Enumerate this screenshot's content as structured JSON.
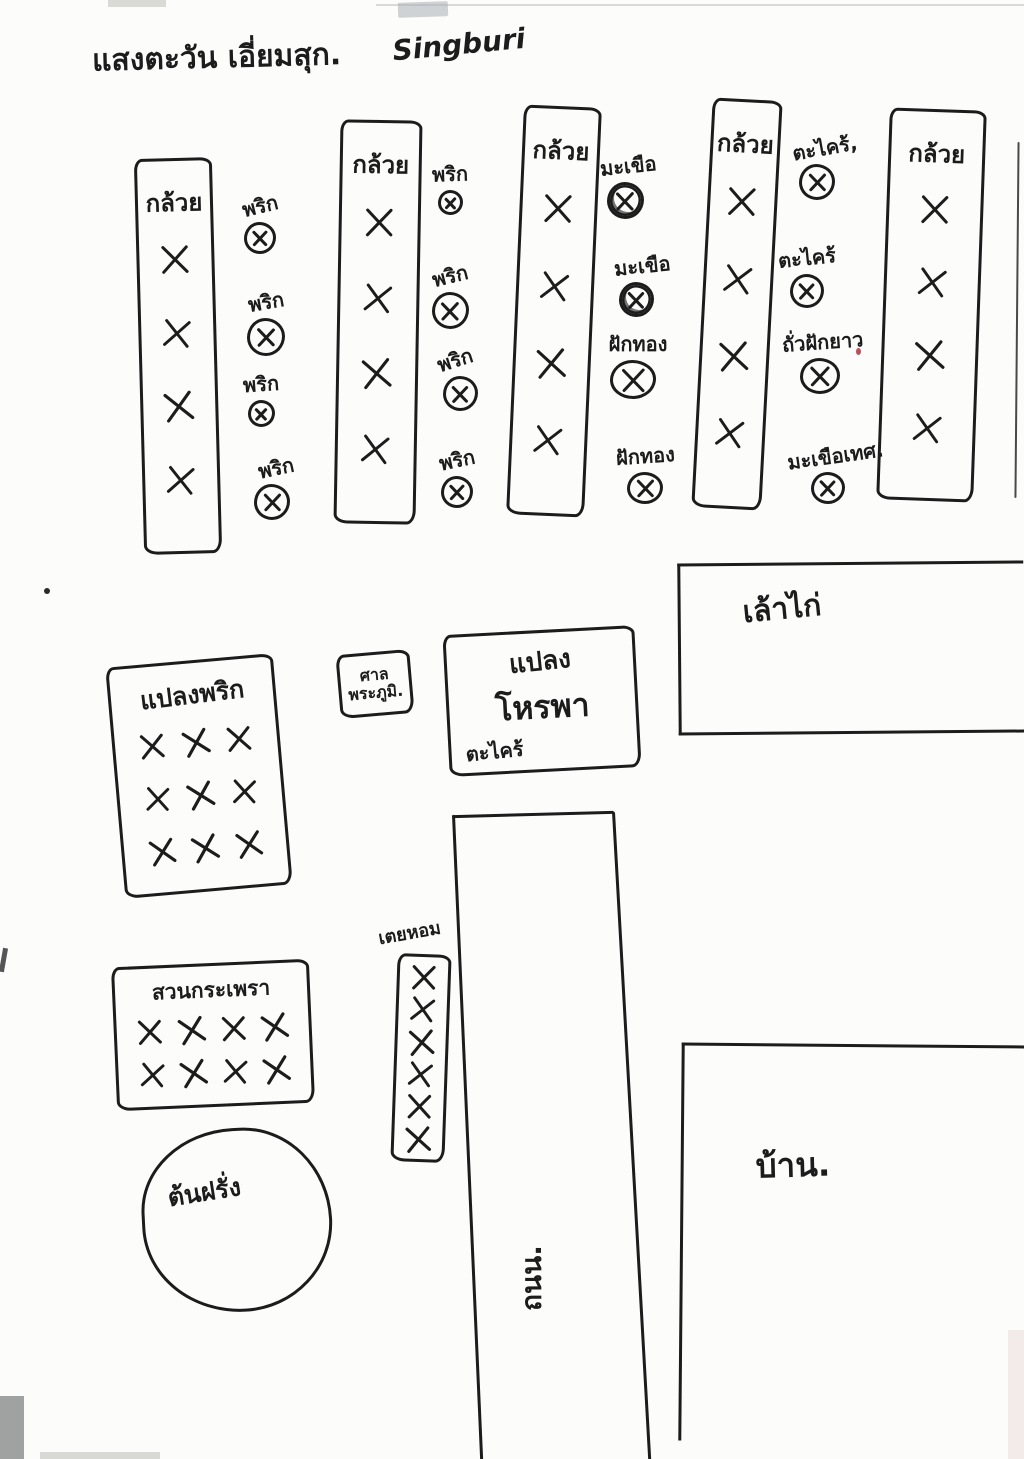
{
  "page": {
    "title_thai": "แสงตะวัน เอี่ยมสุก.",
    "title_latin": "Singburi",
    "ink_color": "#1c1c1c",
    "paper_color": "#fcfcfa"
  },
  "banana_columns": [
    {
      "label": "กล้วย",
      "rows": [
        1,
        1,
        1,
        1
      ]
    },
    {
      "label": "กล้วย",
      "rows": [
        1,
        1,
        1,
        1
      ]
    },
    {
      "label": "กล้วย",
      "rows": [
        1,
        1,
        1,
        1
      ]
    },
    {
      "label": "กล้วย",
      "rows": [
        1,
        1,
        1,
        1
      ]
    },
    {
      "label": "กล้วย",
      "rows": [
        1,
        1,
        1,
        1
      ]
    }
  ],
  "between_rows": [
    {
      "crops": [
        "พริก",
        "พริก",
        "พริก",
        "พริก"
      ]
    },
    {
      "crops": [
        "พริก",
        "พริก",
        "พริก",
        "พริก"
      ]
    },
    {
      "crops": [
        "มะเขือ",
        "มะเขือ",
        "ฝักทอง",
        "ฝักทอง"
      ]
    },
    {
      "crops": [
        "ตะไคร้,",
        "ตะไคร้",
        "ถั่วฝักยาว",
        "มะเขือเทศ."
      ]
    }
  ],
  "plots": {
    "chili": {
      "label": "แปลงพริก",
      "rows": [
        3,
        3,
        3
      ]
    },
    "spirit_house": {
      "line1": "ศาล",
      "line2": "พระภูมิ."
    },
    "basil": {
      "line1": "แปลง",
      "line2": "โหรพา",
      "line3": "ตะไคร้"
    },
    "chicken_coop": {
      "label": "เล้าไก่"
    },
    "holy_basil": {
      "label": "สวนกระเพรา",
      "rows": [
        4,
        4
      ]
    },
    "pandan": {
      "label": "เตยหอม",
      "rows": [
        1,
        1,
        1,
        1,
        1,
        1
      ]
    },
    "guava": {
      "label": "ต้นฝรั่ง"
    },
    "road": {
      "label": "ถนน."
    },
    "house": {
      "label": "บ้าน."
    }
  }
}
